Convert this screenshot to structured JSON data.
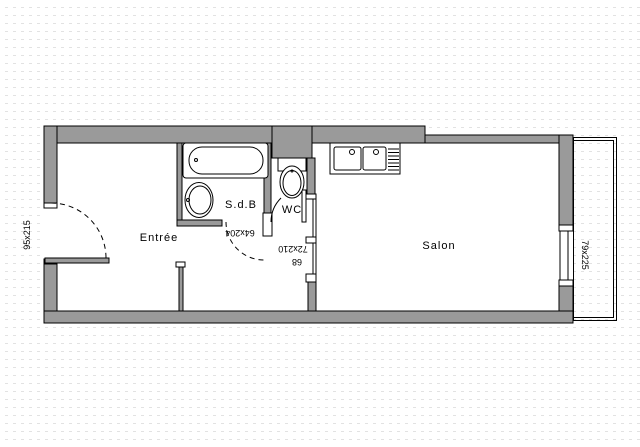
{
  "plan": {
    "rooms": {
      "entree": {
        "label": "Entrée"
      },
      "sdb": {
        "label": "S.d.B"
      },
      "wc": {
        "label": "WC"
      },
      "salon": {
        "label": "Salon"
      }
    },
    "dimension_labels": {
      "entrance_door": "95x215",
      "sdb_door": "64x204",
      "salon_door": "72x210",
      "salon_door_width": "68",
      "salon_window": "79x225"
    },
    "fixtures": {
      "bathtub": "bathtub",
      "washbasin": "washbasin",
      "toilet": "toilet",
      "kitchen_sink": "double-sink-with-drainer",
      "balcony": "balcony",
      "window": "window"
    },
    "colors": {
      "wall_fill": "#9a9a9a",
      "line": "#000000",
      "grid_dash": "#e2e2e2",
      "background": "#ffffff"
    }
  }
}
